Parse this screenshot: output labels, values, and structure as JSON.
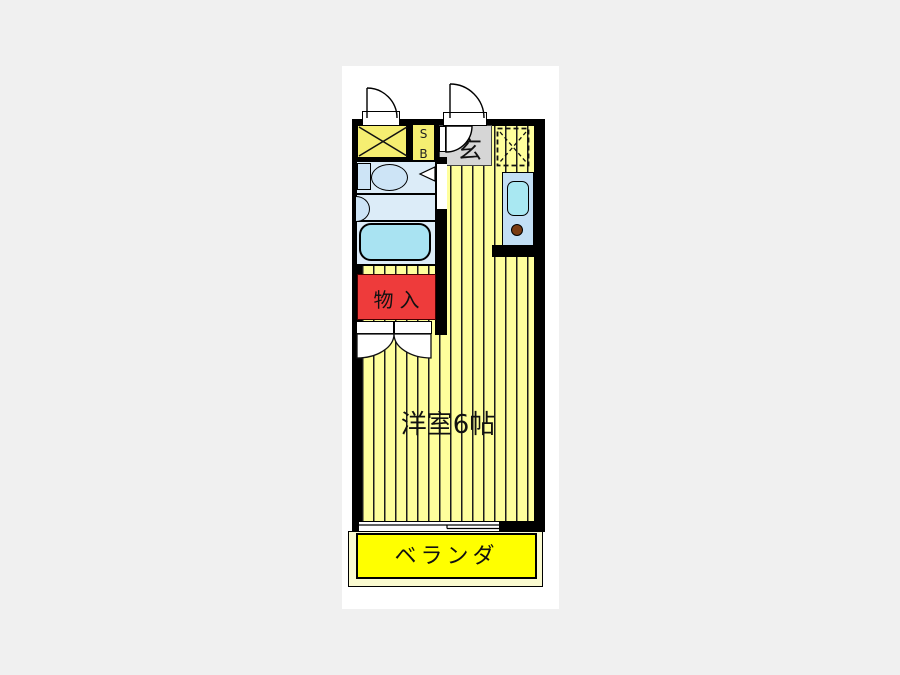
{
  "floorplan": {
    "labels": {
      "shoebox_s": "S",
      "shoebox_b": "B",
      "entrance": "玄",
      "storage": "物入",
      "western_room": "洋室6帖",
      "veranda": "ベランダ"
    },
    "colors": {
      "page_background": "#F0F0F0",
      "paper": "#FFFFFF",
      "wall": "#000000",
      "room_stripe_yellow": "#FFFF9C",
      "closet_yellow": "#F5EE71",
      "veranda_yellow": "#FFFF00",
      "veranda_margin": "#FAFAD0",
      "entrance_gray": "#D6D6D6",
      "storage_red": "#EE3B3B",
      "bath_blue": "#DCECF8",
      "fixture_blue": "#CDE4F6",
      "bathtub_cyan": "#A9E3F2",
      "counter_blue": "#C3DFF5",
      "sink_cyan": "#A9E8F2",
      "burner_brown": "#7A3B12"
    }
  }
}
